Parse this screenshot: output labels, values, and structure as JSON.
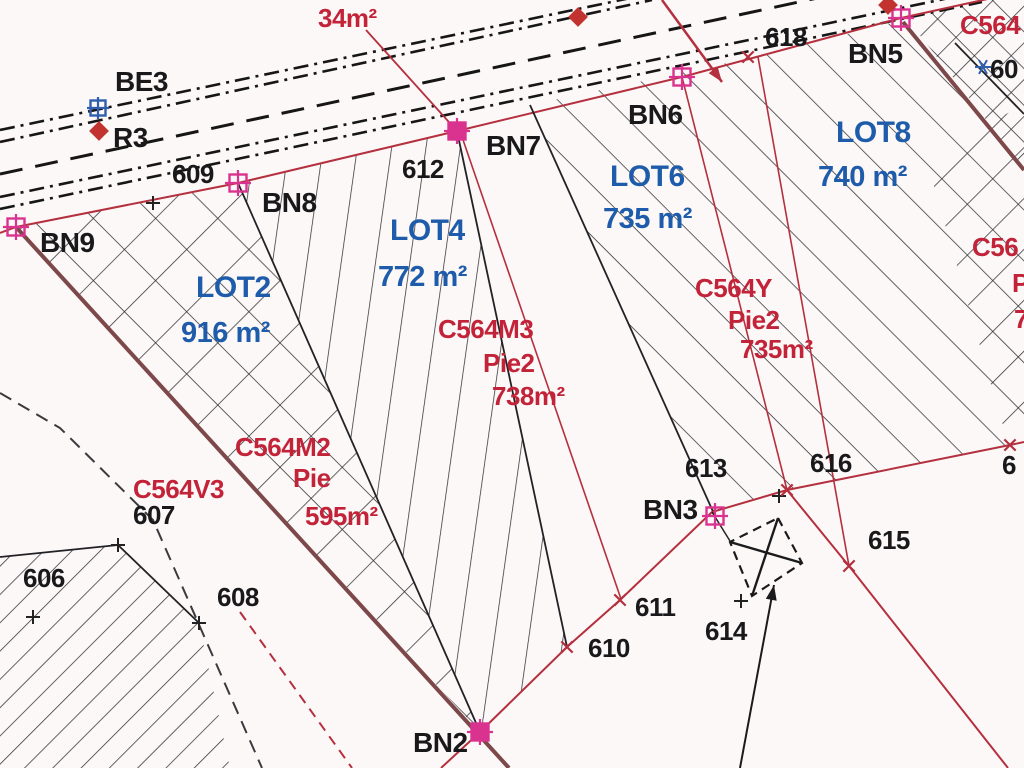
{
  "map": {
    "type": "cadastral-plan",
    "colors": {
      "background": "#fcf8f7",
      "lot_text": "#1e5cab",
      "parcel_text": "#c22339",
      "number_text": "#19191b",
      "survey_line_red": "#b5303f",
      "boundary_maroon": "#7d484a",
      "marker_pink": "#d9338f",
      "marker_blue": "#2f5fae",
      "marker_red": "#c23330",
      "road_black": "#161616",
      "hatch": "#2f2f34"
    },
    "lots": [
      {
        "name": "LOT2",
        "area": "916 m²",
        "name_pos": [
          196,
          297
        ],
        "area_pos": [
          181,
          342
        ]
      },
      {
        "name": "LOT4",
        "area": "772 m²",
        "name_pos": [
          390,
          240
        ],
        "area_pos": [
          378,
          286
        ]
      },
      {
        "name": "LOT6",
        "area": "735 m²",
        "name_pos": [
          610,
          186
        ],
        "area_pos": [
          603,
          228
        ]
      },
      {
        "name": "LOT8",
        "area": "740 m²",
        "name_pos": [
          836,
          142
        ],
        "area_pos": [
          818,
          186
        ]
      }
    ],
    "parcels": [
      {
        "code": "C564M2",
        "labels": [
          {
            "text": "C564M2",
            "x": 235,
            "y": 456
          },
          {
            "text": "Pie",
            "x": 293,
            "y": 487
          },
          {
            "text": "595m²",
            "x": 305,
            "y": 525
          }
        ]
      },
      {
        "code": "C564M3",
        "labels": [
          {
            "text": "C564M3",
            "x": 438,
            "y": 338
          },
          {
            "text": "Pie2",
            "x": 483,
            "y": 372
          },
          {
            "text": "738m²",
            "x": 492,
            "y": 405
          }
        ]
      },
      {
        "code": "C564Y",
        "labels": [
          {
            "text": "C564Y",
            "x": 695,
            "y": 297
          },
          {
            "text": "Pie2",
            "x": 728,
            "y": 329
          },
          {
            "text": "735m²",
            "x": 740,
            "y": 358
          }
        ]
      },
      {
        "code": "C564V3",
        "labels": [
          {
            "text": "C564V3",
            "x": 133,
            "y": 498
          }
        ]
      },
      {
        "code": "C564-top-right",
        "labels": [
          {
            "text": "C564",
            "x": 960,
            "y": 34
          }
        ]
      },
      {
        "code": "C56-right-edge",
        "labels": [
          {
            "text": "C56",
            "x": 972,
            "y": 256
          },
          {
            "text": "P",
            "x": 1012,
            "y": 292
          },
          {
            "text": "7",
            "x": 1014,
            "y": 328
          }
        ]
      }
    ],
    "annotations": [
      {
        "text": "34m²",
        "x": 318,
        "y": 27
      }
    ],
    "survey_points": [
      {
        "name": "BE3",
        "label": [
          115,
          91
        ],
        "marker": {
          "type": "blue-square",
          "x": 98,
          "y": 108
        }
      },
      {
        "name": "R3",
        "label": [
          113,
          147
        ],
        "marker": {
          "type": "red-diamond",
          "x": 99,
          "y": 131
        }
      },
      {
        "name": "BN9",
        "label": [
          40,
          252
        ],
        "marker": {
          "type": "pink-square",
          "x": 16,
          "y": 227
        }
      },
      {
        "name": "BN8",
        "label": [
          262,
          212
        ],
        "marker": {
          "type": "pink-square",
          "x": 238,
          "y": 183
        }
      },
      {
        "name": "BN7",
        "label": [
          486,
          155
        ],
        "marker": {
          "type": "pink-square-filled",
          "x": 457,
          "y": 131
        }
      },
      {
        "name": "BN6",
        "label": [
          628,
          124
        ],
        "marker": {
          "type": "pink-square",
          "x": 682,
          "y": 77
        }
      },
      {
        "name": "BN5",
        "label": [
          848,
          63
        ],
        "marker": {
          "type": "pink-square",
          "x": 901,
          "y": 18
        }
      },
      {
        "name": "BN3",
        "label": [
          643,
          519
        ],
        "marker": {
          "type": "pink-square",
          "x": 715,
          "y": 516
        }
      },
      {
        "name": "BN2",
        "label": [
          413,
          752
        ],
        "marker": {
          "type": "pink-square-filled",
          "x": 480,
          "y": 732
        }
      }
    ],
    "point_numbers": [
      {
        "text": "606",
        "x": 23,
        "y": 587
      },
      {
        "text": "607",
        "x": 133,
        "y": 524
      },
      {
        "text": "608",
        "x": 217,
        "y": 606
      },
      {
        "text": "609",
        "x": 172,
        "y": 183
      },
      {
        "text": "610",
        "x": 588,
        "y": 657
      },
      {
        "text": "611",
        "x": 635,
        "y": 616
      },
      {
        "text": "612",
        "x": 402,
        "y": 178
      },
      {
        "text": "613",
        "x": 685,
        "y": 477
      },
      {
        "text": "614",
        "x": 705,
        "y": 640
      },
      {
        "text": "615",
        "x": 868,
        "y": 549
      },
      {
        "text": "616",
        "x": 810,
        "y": 472
      },
      {
        "text": "618",
        "x": 765,
        "y": 46
      },
      {
        "text": "60",
        "x": 990,
        "y": 78
      },
      {
        "text": "6",
        "x": 1002,
        "y": 474
      }
    ]
  }
}
